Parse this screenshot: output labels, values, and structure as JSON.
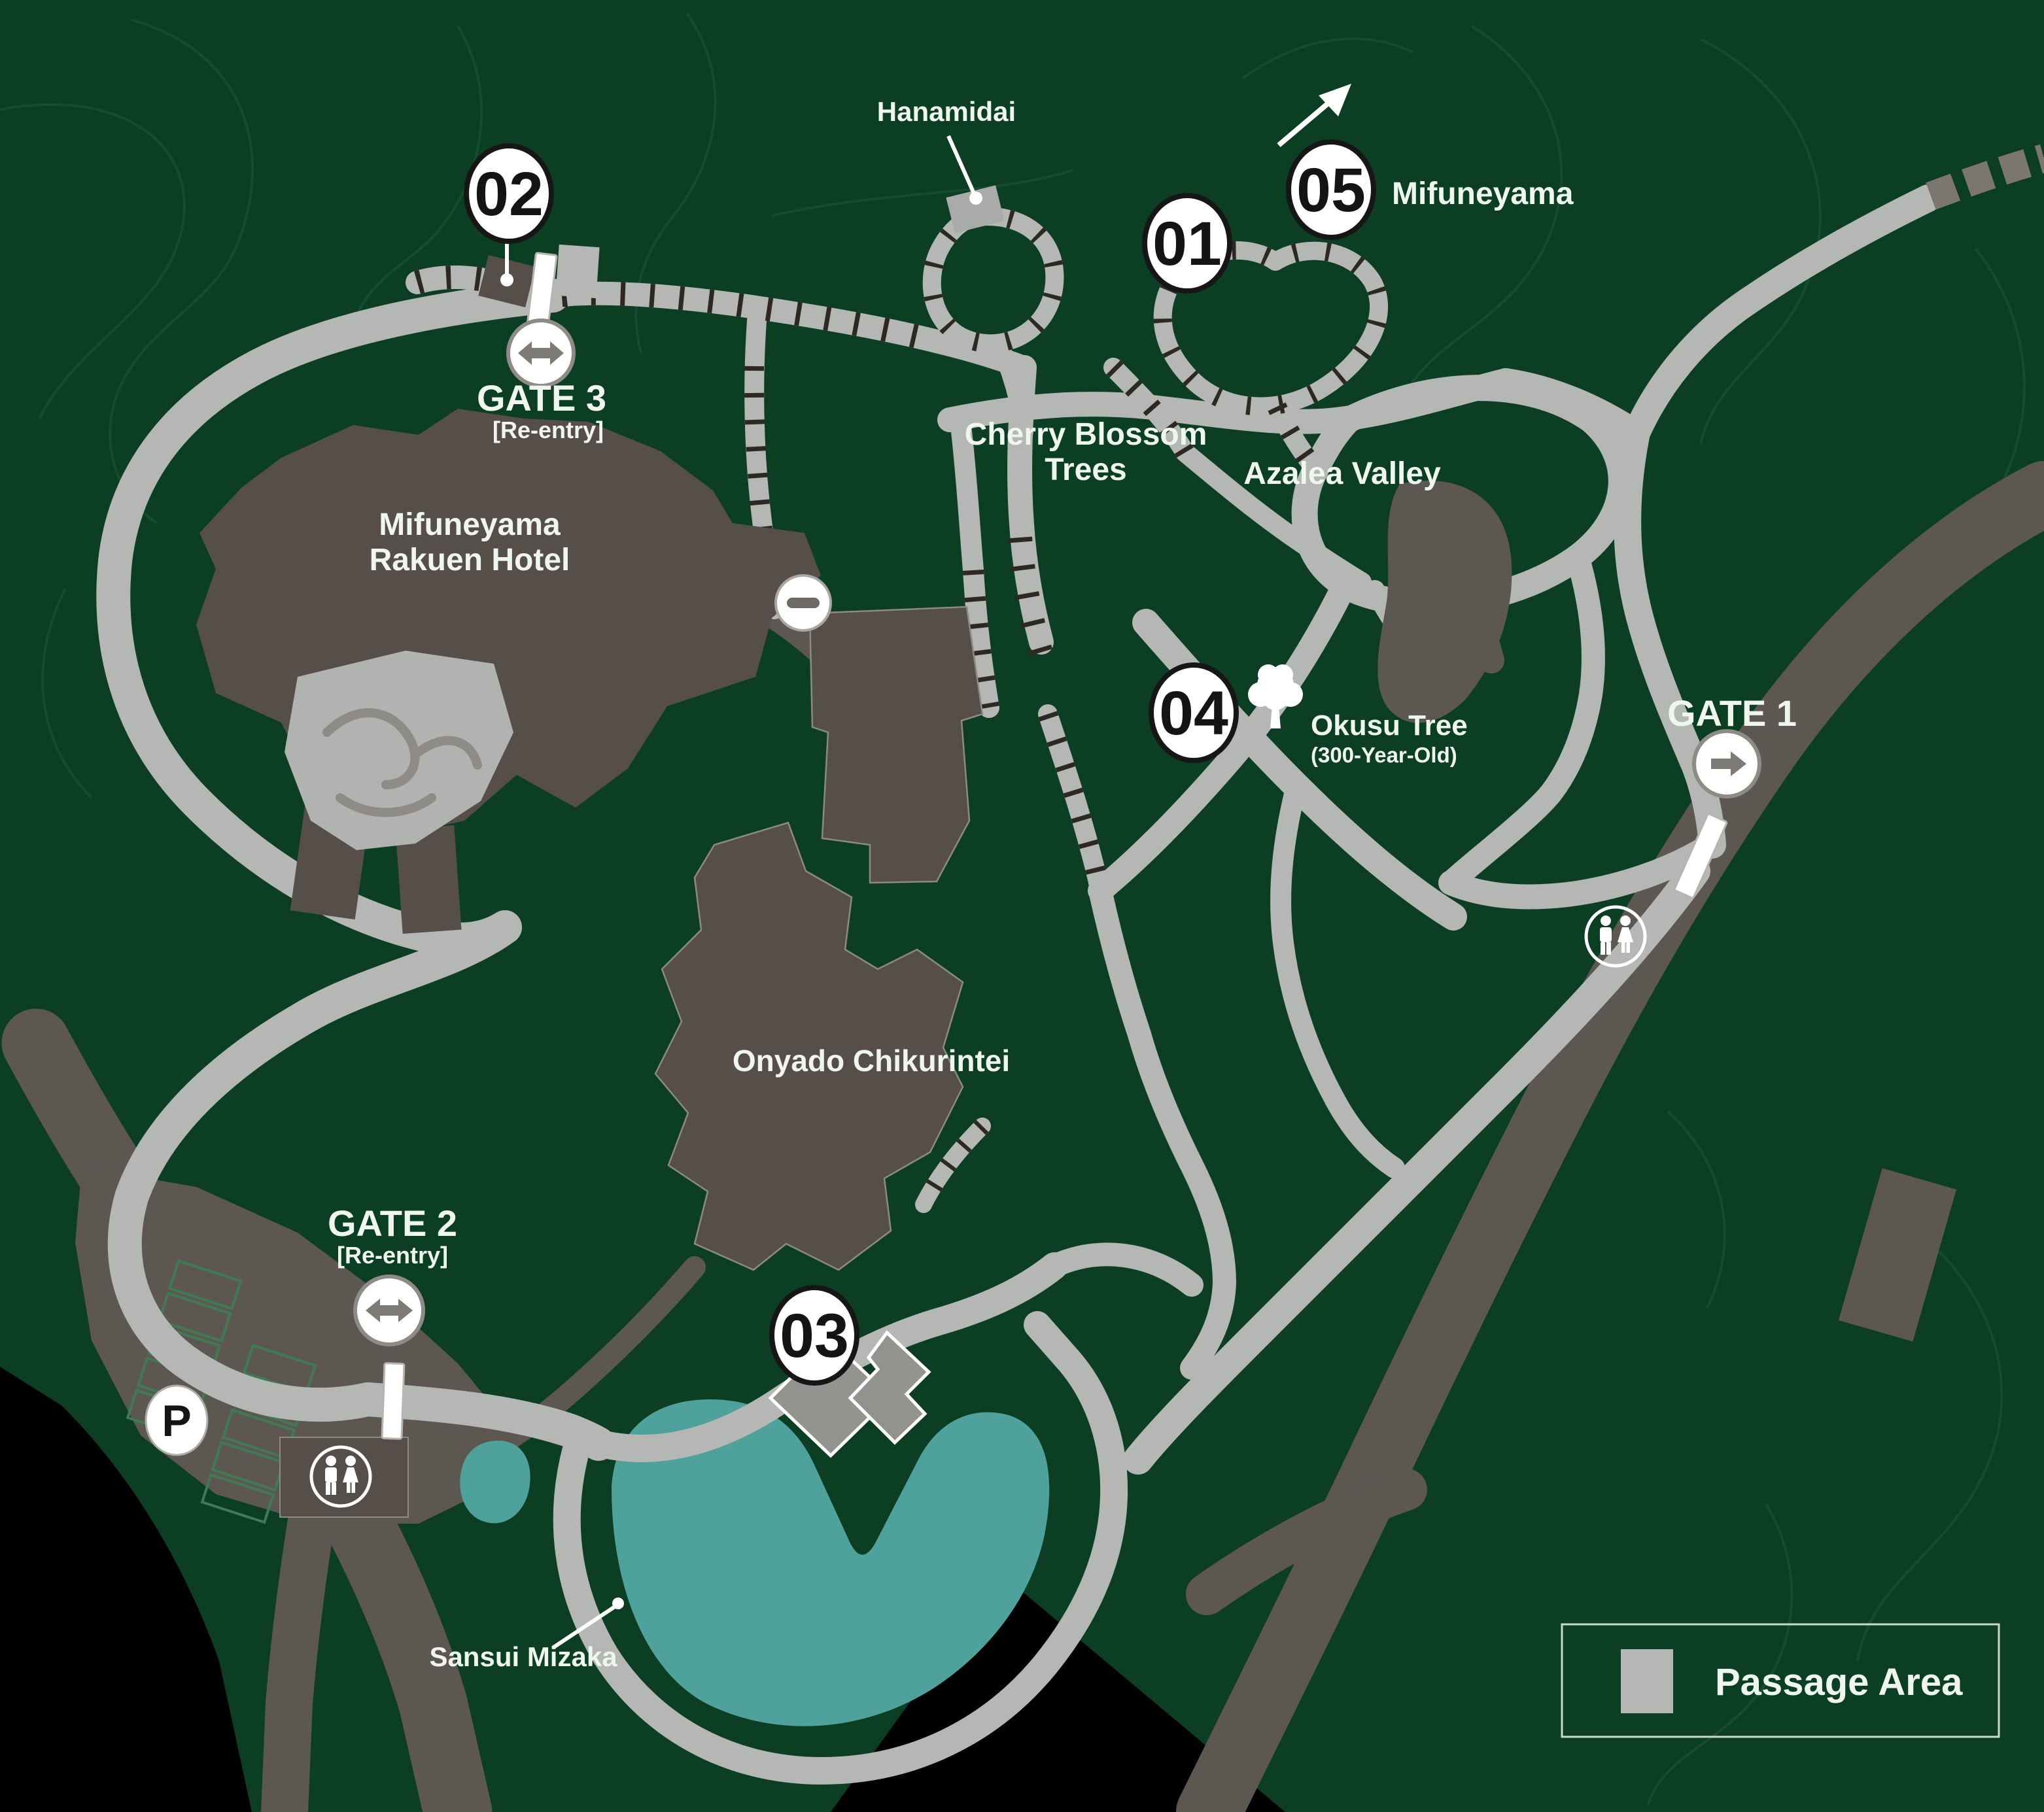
{
  "map": {
    "markers": {
      "m01": "01",
      "m02": "02",
      "m03": "03",
      "m04": "04",
      "m05": "05"
    },
    "labels": {
      "hanamidai": "Hanamidai",
      "mifuneyama_summit": "Mifuneyama",
      "cherry_blossom_line1": "Cherry Blossom",
      "cherry_blossom_line2": "Trees",
      "azalea_valley": "Azalea Valley",
      "hotel_line1": "Mifuneyama",
      "hotel_line2": "Rakuen Hotel",
      "okusu_tree": "Okusu Tree",
      "okusu_tree_age": "(300-Year-Old)",
      "onyado_chikurintei": "Onyado Chikurintei",
      "sansui_mizaka": "Sansui Mizaka",
      "gate1": "GATE 1",
      "gate2": "GATE 2",
      "gate3": "GATE 3",
      "reentry": "[Re-entry]",
      "parking_letter": "P"
    },
    "legend": {
      "passage_area_label": "Passage Area"
    },
    "icons": [
      "two-way-arrow-icon",
      "right-arrow-icon",
      "no-entry-icon",
      "restroom-icon",
      "parking-icon",
      "tree-icon",
      "summit-arrow-icon"
    ],
    "colors": {
      "background": "#0b3e23",
      "contour_line": "#164c2c",
      "passage_area": "#b5b7b4",
      "road": "#5d5752",
      "building": "#564f49",
      "building_light": "#93948f",
      "pond": "#4fa29b",
      "outside": "#000000",
      "label_text": "#eef6ee",
      "stair_tick": "#2e2822"
    }
  }
}
